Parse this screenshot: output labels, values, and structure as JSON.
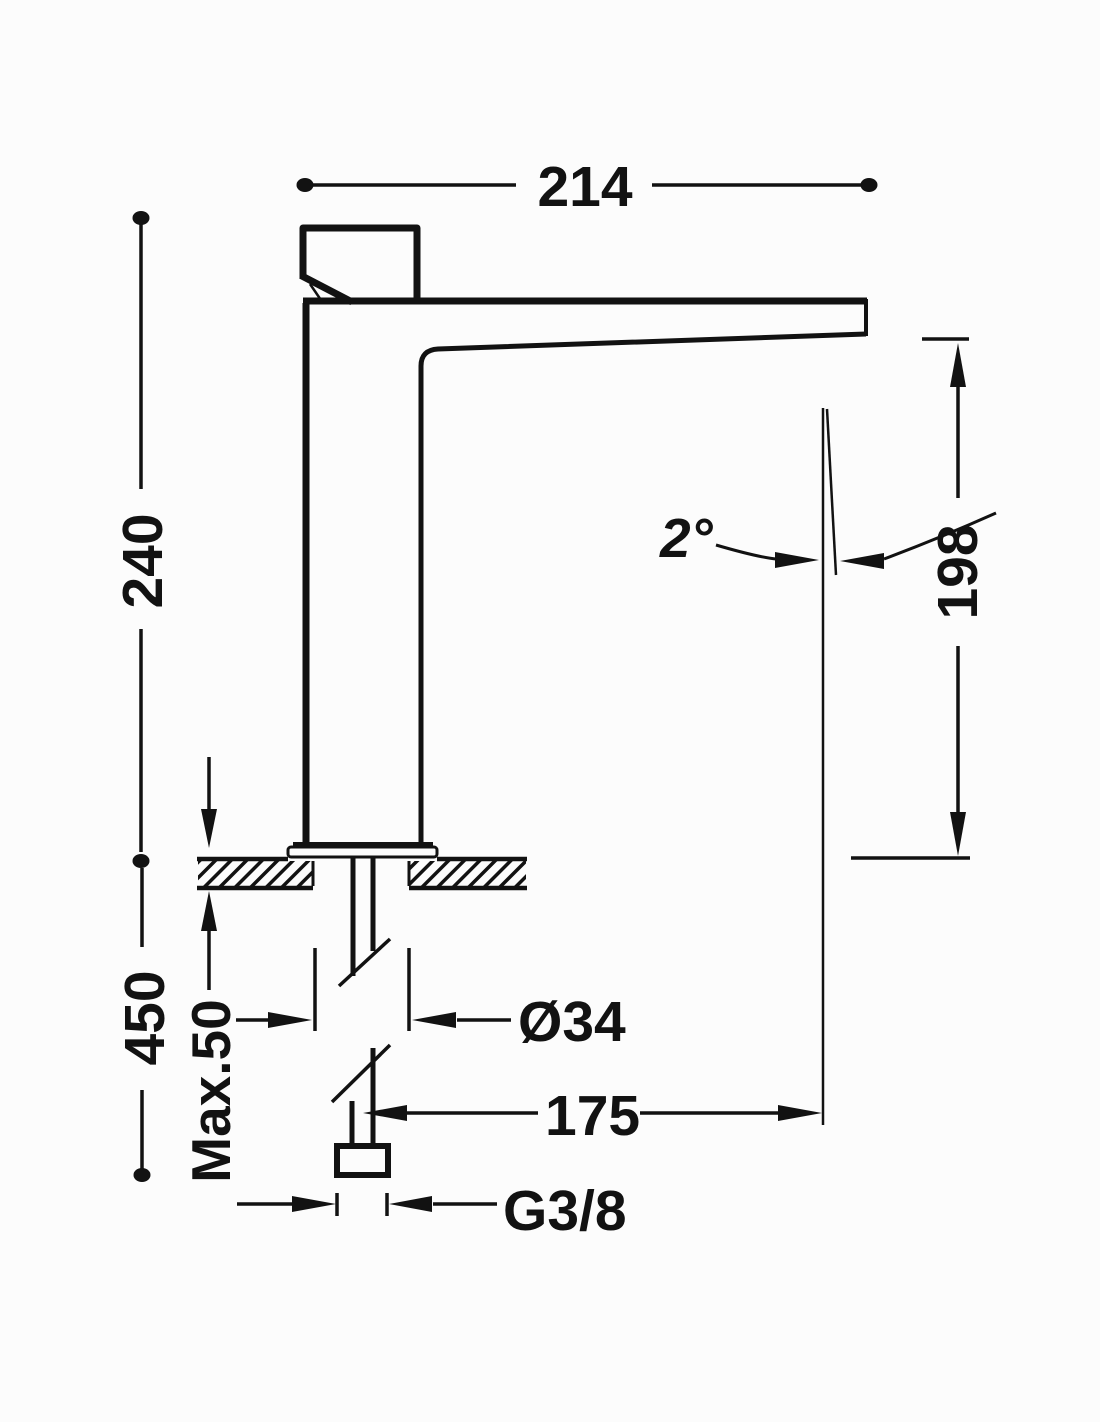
{
  "meta": {
    "type": "technical-dimension-drawing",
    "subject": "single-lever tall basin mixer tap, side elevation with installation dimensions",
    "units": "mm",
    "line_color": "#121212",
    "background_color": "#fcfcfc"
  },
  "labels": {
    "overall_width": "214",
    "overall_height": "240",
    "spout_outlet_height": "198",
    "spout_reach": "175",
    "hole_diameter": "Ø34",
    "max_deck_thickness": "Max.50",
    "supply_extent": "450",
    "connection_thread": "G3/8",
    "outlet_angle": "2°"
  }
}
